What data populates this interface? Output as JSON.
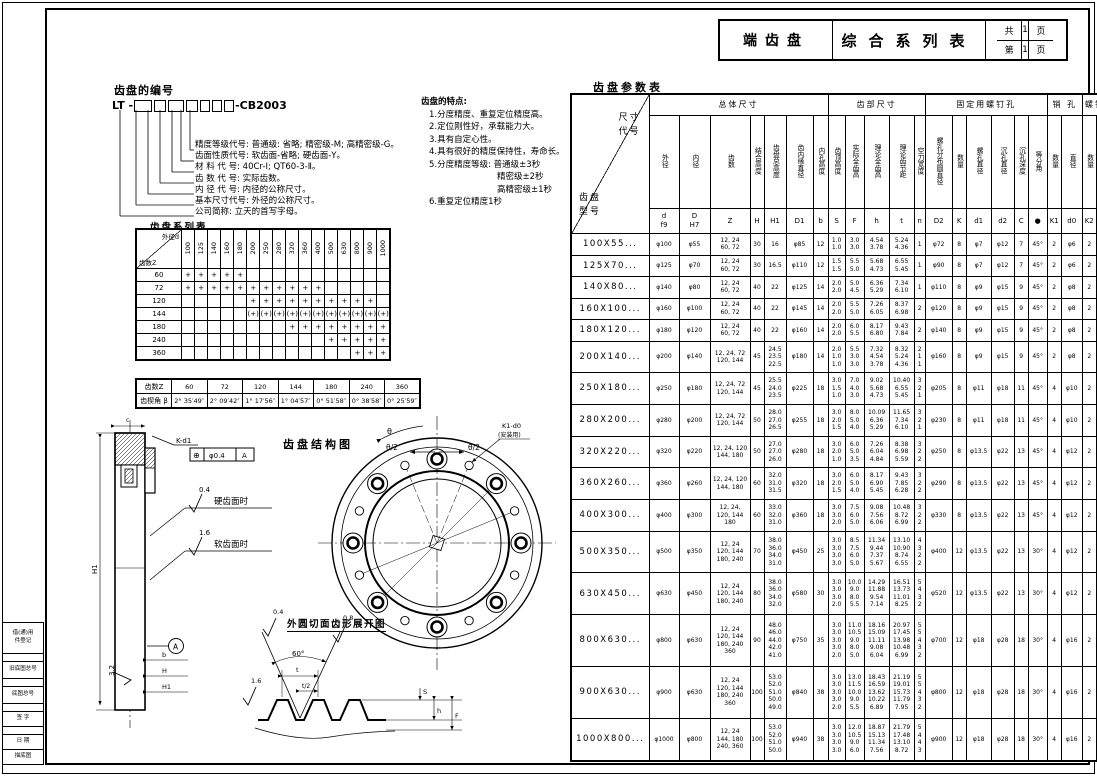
{
  "title_block": {
    "product": "端齿盘",
    "title": "综合系列表",
    "total_label": "共",
    "total_pages": "1",
    "page_label": "第",
    "page_no": "1",
    "page_unit": "页"
  },
  "numbering": {
    "heading": "齿盘的编号",
    "code_prefix": "LT -",
    "code_suffix": "-CB2003",
    "legend": [
      "精度等级代号: 普通级: 省略; 精密级-M; 高精密级-G。",
      "齿面性质代号: 软齿面-省略; 硬齿面-Y。",
      "材 料 代 号: 40Cr-Ⅰ; QT60-3-Ⅱ。",
      "齿 数 代 号: 实际齿数。",
      "内 径 代 号: 内径的公称尺寸。",
      "基本尺寸代号: 外径的公称尺寸。",
      "公司简称: 立天的首写字母。"
    ]
  },
  "features": [
    {
      "t": "齿盘的特点:",
      "i": 0
    },
    {
      "t": "1.分度精度、重复定位精度高。",
      "i": 1
    },
    {
      "t": "2.定位刚性好，承载能力大。",
      "i": 1
    },
    {
      "t": "3.具有自定心性。",
      "i": 1
    },
    {
      "t": "4.具有很好的精度保持性，寿命长。",
      "i": 1
    },
    {
      "t": "5.分度精度等级: 普通级±3秒",
      "i": 1
    },
    {
      "t": "精密级±2秒",
      "i": 2
    },
    {
      "t": "高精密级±1秒",
      "i": 2
    },
    {
      "t": "6.重复定位精度1秒",
      "i": 1
    }
  ],
  "series_table": {
    "caption": "齿盘系列表",
    "corner_top": "外径d",
    "corner_bottom": "齿数Z",
    "columns": [
      "100",
      "125",
      "140",
      "160",
      "180",
      "200",
      "250",
      "280",
      "320",
      "360",
      "400",
      "500",
      "630",
      "800",
      "900",
      "1000"
    ],
    "rows": [
      {
        "z": "60",
        "marks": [
          "+",
          "+",
          "+",
          "+",
          "+",
          "",
          "",
          "",
          "",
          "",
          "",
          "",
          "",
          "",
          "",
          ""
        ]
      },
      {
        "z": "72",
        "marks": [
          "+",
          "+",
          "+",
          "+",
          "+",
          "+",
          "+",
          "+",
          "+",
          "+",
          "+",
          "",
          "",
          "",
          "",
          ""
        ]
      },
      {
        "z": "120",
        "marks": [
          "",
          "",
          "",
          "",
          "",
          "+",
          "+",
          "+",
          "+",
          "+",
          "+",
          "+",
          "+",
          "+",
          "+",
          ""
        ]
      },
      {
        "z": "144",
        "marks": [
          "",
          "",
          "",
          "",
          "",
          "(+)",
          "(+)",
          "(+)",
          "(+)",
          "(+)",
          "(+)",
          "(+)",
          "(+)",
          "(+)",
          "(+)",
          "(+)"
        ]
      },
      {
        "z": "180",
        "marks": [
          "",
          "",
          "",
          "",
          "",
          "",
          "",
          "",
          "+",
          "+",
          "+",
          "+",
          "+",
          "+",
          "+",
          "+"
        ]
      },
      {
        "z": "240",
        "marks": [
          "",
          "",
          "",
          "",
          "",
          "",
          "",
          "",
          "",
          "",
          "",
          "+",
          "+",
          "+",
          "+",
          "+"
        ]
      },
      {
        "z": "360",
        "marks": [
          "",
          "",
          "",
          "",
          "",
          "",
          "",
          "",
          "",
          "",
          "",
          "",
          "",
          "+",
          "+",
          "+"
        ]
      }
    ]
  },
  "angle_table": {
    "row1_label": "齿数Z",
    "row2_label": "齿楔角 β",
    "columns": [
      "60",
      "72",
      "120",
      "144",
      "180",
      "240",
      "360"
    ],
    "angles": [
      "2° 35′49″",
      "2° 09′42″",
      "1° 17′56″",
      "1° 04′57″",
      "0° 51′58″",
      "0° 38′58″",
      "0° 25′59″"
    ]
  },
  "structure": {
    "title": "齿盘结构图",
    "dev_title": "外圆切面齿形展开图",
    "labels": {
      "hard_face": "硬齿面时",
      "soft_face": "软齿面时",
      "r04": "0.4",
      "r08": "0.8",
      "r16a": "1.6",
      "r16b": "1.6",
      "r32": "3.2",
      "k_d1": "K-d1",
      "tol_sym": "⊕",
      "tol_val": "φ0.4",
      "tol_datum": "A",
      "datum": "A",
      "theta": "θ",
      "theta2_l": "θ/2",
      "theta2_r": "θ/2",
      "k1d0": "K1-d0",
      "install": "(安装用)",
      "deg60": "60°",
      "t": "t",
      "t_half": "t/2",
      "dim_b": "b",
      "dim_H": "H",
      "dim_H1": "H1",
      "dim_H1L": "H1",
      "dim_h": "h",
      "dim_S": "S",
      "dim_F": "F",
      "dim_c": "c"
    }
  },
  "param_table": {
    "caption": "齿盘参数表",
    "corner": {
      "top": "尺寸\n代号",
      "bottom": "齿盘\n型号"
    },
    "groups": [
      {
        "label": "总体尺寸",
        "span": 7
      },
      {
        "label": "齿部尺寸",
        "span": 5
      },
      {
        "label": "固定用螺钉孔",
        "span": 6
      },
      {
        "label": "销 孔",
        "span": 2
      },
      {
        "label": "螺钉孔",
        "span": 2
      }
    ],
    "col_labels": [
      "外径",
      "内径",
      "齿数",
      "结合高度",
      "齿盘总高度",
      "齿内缘直径",
      "内孔高度",
      "齿顶高度",
      "实际全齿高",
      "理论全齿高",
      "理论齿节距",
      "空刀宽度",
      "螺孔分布圆直径",
      "数量",
      "螺孔直径",
      "沉孔直径",
      "沉孔深度",
      "等分角",
      "数量",
      "直径",
      "数量",
      "直径"
    ],
    "symbols": [
      "d\nf9",
      "D\nH7",
      "Z",
      "H",
      "H1",
      "D1",
      "b",
      "S",
      "F",
      "h",
      "t",
      "n",
      "D2",
      "K",
      "d1",
      "d2",
      "C",
      "●",
      "K1",
      "d0",
      "K2",
      "d3"
    ],
    "rows": [
      {
        "model": "100X55...",
        "cells": [
          "φ100",
          "φ55",
          "12, 24\n60, 72",
          "30",
          "16",
          "φ85",
          "12",
          "1.0\n1.0",
          "3.0\n3.0",
          "4.54\n3.78",
          "5.24\n4.36",
          "1",
          "φ72",
          "8",
          "φ7",
          "φ12",
          "7",
          "45°",
          "2",
          "φ6",
          "2",
          "M6"
        ]
      },
      {
        "model": "125X70...",
        "cells": [
          "φ125",
          "φ70",
          "12, 24\n60, 72",
          "30",
          "16.5",
          "φ110",
          "12",
          "1.5\n1.5",
          "5.5\n5.0",
          "5.68\n4.73",
          "6.55\n5.45",
          "1",
          "φ90",
          "8",
          "φ7",
          "φ12",
          "7",
          "45°",
          "2",
          "φ6",
          "2",
          "M6"
        ]
      },
      {
        "model": "140X80...",
        "cells": [
          "φ140",
          "φ80",
          "12, 24\n60, 72",
          "40",
          "22",
          "φ125",
          "14",
          "2.0\n2.0",
          "5.0\n4.5",
          "6.36\n5.29",
          "7.34\n6.10",
          "1",
          "φ110",
          "8",
          "φ9",
          "φ15",
          "9",
          "45°",
          "2",
          "φ8",
          "2",
          "M8"
        ]
      },
      {
        "model": "160X100...",
        "cells": [
          "φ160",
          "φ100",
          "12, 24\n60, 72",
          "40",
          "22",
          "φ145",
          "14",
          "2.0\n2.0",
          "5.5\n5.0",
          "7.26\n6.05",
          "8.37\n6.98",
          "2",
          "φ120",
          "8",
          "φ9",
          "φ15",
          "9",
          "45°",
          "2",
          "φ8",
          "2",
          "M8"
        ]
      },
      {
        "model": "180X120...",
        "cells": [
          "φ180",
          "φ120",
          "12, 24\n60, 72",
          "40",
          "22",
          "φ160",
          "14",
          "2.0\n2.0",
          "6.0\n5.5",
          "8.17\n6.80",
          "9.43\n7.84",
          "2",
          "φ140",
          "8",
          "φ9",
          "φ15",
          "9",
          "45°",
          "2",
          "φ8",
          "2",
          "M8"
        ]
      },
      {
        "model": "200X140...",
        "cells": [
          "φ200",
          "φ140",
          "12, 24, 72\n120, 144",
          "45",
          "24.5\n23.5\n22.5",
          "φ180",
          "14",
          "2.0\n1.0\n1.0",
          "5.5\n3.0\n3.0",
          "7.32\n4.54\n3.78",
          "8.32\n5.24\n4.36",
          "2\n1\n1",
          "φ160",
          "8",
          "φ9",
          "φ15",
          "9",
          "45°",
          "2",
          "φ8",
          "2",
          "M8"
        ]
      },
      {
        "model": "250X180...",
        "cells": [
          "φ250",
          "φ180",
          "12, 24, 72\n120, 144",
          "45",
          "25.5\n24.0\n23.5",
          "φ225",
          "18",
          "3.0\n1.5\n1.0",
          "7.0\n4.0\n3.0",
          "9.02\n5.68\n4.73",
          "10.40\n6.55\n5.45",
          "3\n2\n1",
          "φ205",
          "8",
          "φ11",
          "φ18",
          "11",
          "45°",
          "4",
          "φ10",
          "2",
          "M10"
        ]
      },
      {
        "model": "280X200...",
        "cells": [
          "φ280",
          "φ200",
          "12, 24, 72\n120, 144",
          "50",
          "28.0\n27.0\n26.5",
          "φ255",
          "18",
          "3.0\n2.0\n1.5",
          "8.0\n5.0\n4.0",
          "10.09\n6.36\n5.29",
          "11.65\n7.34\n6.10",
          "3\n2\n1",
          "φ230",
          "8",
          "φ11",
          "φ18",
          "11",
          "45°",
          "4",
          "φ10",
          "2",
          "M10"
        ]
      },
      {
        "model": "320X220...",
        "cells": [
          "φ320",
          "φ220",
          "12, 24, 120\n144, 180",
          "50",
          "27.0\n27.0\n26.0",
          "φ280",
          "18",
          "3.0\n2.0\n1.0",
          "6.0\n5.0\n3.5",
          "7.26\n6.04\n4.84",
          "8.38\n6.98\n5.59",
          "3\n2\n2",
          "φ250",
          "8",
          "φ13.5",
          "φ22",
          "13",
          "45°",
          "4",
          "φ12",
          "2",
          "M10"
        ]
      },
      {
        "model": "360X260...",
        "cells": [
          "φ360",
          "φ260",
          "12, 24, 120\n144, 180",
          "60",
          "32.0\n31.0\n31.5",
          "φ320",
          "18",
          "3.0\n2.0\n1.5",
          "6.0\n5.0\n4.0",
          "8.17\n6.90\n5.45",
          "9.43\n7.85\n6.28",
          "3\n2\n2",
          "φ290",
          "8",
          "φ13.5",
          "φ22",
          "13",
          "45°",
          "4",
          "φ12",
          "2",
          "M10"
        ]
      },
      {
        "model": "400X300...",
        "cells": [
          "φ400",
          "φ300",
          "12, 24,\n120, 144\n180",
          "60",
          "33.0\n32.0\n31.0",
          "φ360",
          "18",
          "3.0\n3.0\n2.0",
          "7.5\n6.0\n5.0",
          "9.08\n7.56\n6.06",
          "10.48\n8.72\n6.99",
          "3\n2\n2",
          "φ330",
          "8",
          "φ13.5",
          "φ22",
          "13",
          "45°",
          "4",
          "φ12",
          "2",
          "M10"
        ]
      },
      {
        "model": "500X350...",
        "cells": [
          "φ500",
          "φ350",
          "12, 24\n120, 144\n180, 240",
          "70",
          "38.0\n36.0\n34.0\n31.0",
          "φ450",
          "25",
          "3.0\n3.0\n3.0\n3.0",
          "8.5\n7.5\n6.0\n5.0",
          "11.34\n9.44\n7.37\n5.67",
          "13.10\n10.90\n8.74\n6.55",
          "4\n3\n2\n2",
          "φ400",
          "12",
          "φ13.5",
          "φ22",
          "13",
          "30°",
          "4",
          "φ12",
          "2",
          "M12"
        ]
      },
      {
        "model": "630X450...",
        "cells": [
          "φ630",
          "φ450",
          "12, 24\n120, 144\n180, 240",
          "80",
          "38.0\n36.0\n34.0\n32.0",
          "φ580",
          "30",
          "3.0\n3.0\n3.0\n2.0",
          "10.0\n9.0\n8.0\n5.5",
          "14.29\n11.88\n9.54\n7.14",
          "16.51\n13.73\n11.01\n8.25",
          "5\n4\n3\n2",
          "φ520",
          "12",
          "φ13.5",
          "φ22",
          "13",
          "30°",
          "4",
          "φ12",
          "2",
          "M12"
        ]
      },
      {
        "model": "800X630...",
        "cells": [
          "φ800",
          "φ630",
          "12, 24\n120, 144\n180, 240\n360",
          "90",
          "48.0\n46.0\n44.0\n42.0\n41.0",
          "φ750",
          "35",
          "3.0\n3.0\n3.0\n3.0\n2.0",
          "11.0\n10.5\n9.0\n8.0\n5.0",
          "18.16\n15.09\n11.11\n9.08\n6.04",
          "20.97\n17.45\n13.98\n10.48\n6.99",
          "5\n5\n4\n3\n2",
          "φ700",
          "12",
          "φ18",
          "φ28",
          "18",
          "30°",
          "4",
          "φ16",
          "2",
          "M16"
        ]
      },
      {
        "model": "900X630...",
        "cells": [
          "φ900",
          "φ630",
          "12, 24\n120, 144\n180, 240\n360",
          "100",
          "53.0\n52.0\n51.0\n50.0\n49.0",
          "φ840",
          "38",
          "3.0\n3.0\n3.0\n3.0\n2.0",
          "13.0\n11.5\n10.0\n9.0\n5.5",
          "18.43\n16.59\n13.62\n10.22\n6.89",
          "21.19\n19.01\n15.73\n11.79\n7.95",
          "5\n5\n4\n3\n2",
          "φ800",
          "12",
          "φ18",
          "φ28",
          "18",
          "30°",
          "4",
          "φ16",
          "2",
          "M16"
        ]
      },
      {
        "model": "1000X800...",
        "cells": [
          "φ1000",
          "φ800",
          "12, 24\n144, 180\n240, 360",
          "100",
          "53.0\n52.0\n51.0\n50.0",
          "φ940",
          "38",
          "3.0\n3.0\n3.0\n3.0",
          "12.0\n10.5\n9.0\n6.0",
          "18.87\n15.13\n11.34\n7.56",
          "21.79\n17.48\n13.10\n8.72",
          "5\n4\n4\n3",
          "φ900",
          "12",
          "φ18",
          "φ28",
          "18",
          "30°",
          "4",
          "φ16",
          "2",
          "M16"
        ]
      }
    ]
  },
  "margin_fields": [
    {
      "t": "借(通)用\n件登记",
      "h": 30
    },
    {
      "t": "",
      "h": 7
    },
    {
      "t": "旧底图总号",
      "h": 16
    },
    {
      "t": "",
      "h": 7
    },
    {
      "t": "底图总号",
      "h": 16
    },
    {
      "t": "",
      "h": 7
    },
    {
      "t": "签  字",
      "h": 14
    },
    {
      "t": "",
      "h": 7
    },
    {
      "t": "日  期",
      "h": 14
    },
    {
      "t": "描底图",
      "h": 14
    }
  ]
}
